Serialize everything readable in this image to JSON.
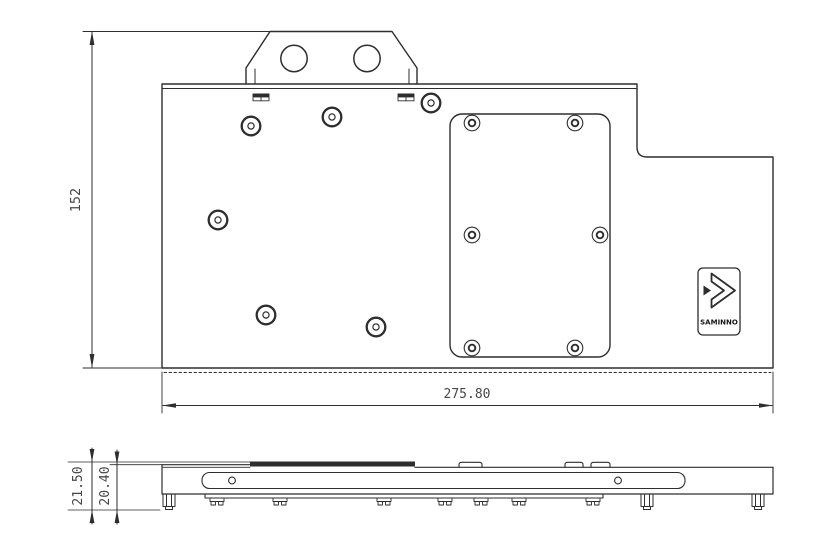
{
  "drawing": {
    "background_color": "#ffffff",
    "line_color": "#2e2e2e",
    "dimension_text_color": "#474747",
    "top_view": {
      "dim_height": "152",
      "dim_width": "275.80"
    },
    "side_view": {
      "dim_total_height": "21.50",
      "dim_body_height": "20.40"
    },
    "logo_badge": {
      "icon": "double-chevron-right-icon",
      "wordmark": "SAMINNO"
    }
  }
}
